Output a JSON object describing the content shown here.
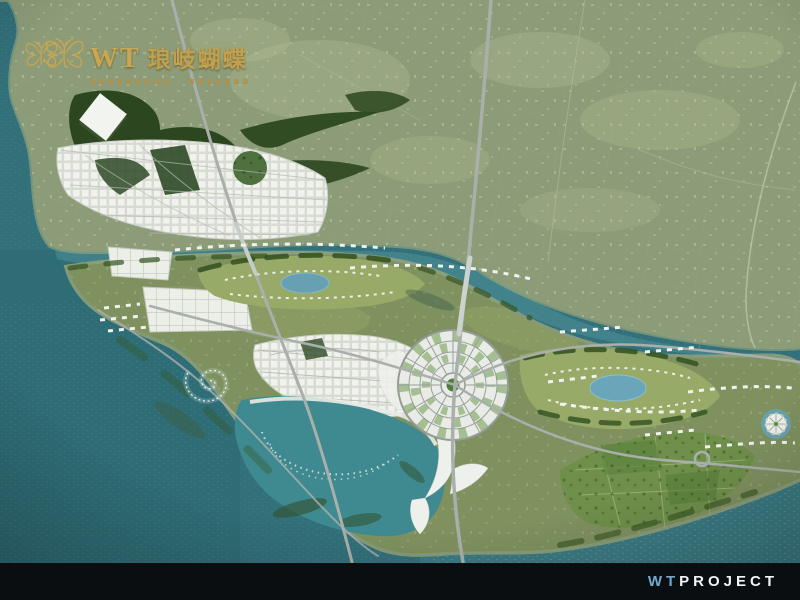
{
  "logo": {
    "brand": "WT",
    "name": "琅岐蝴蝶",
    "gold_color": "#c9a752",
    "icon": "butterfly-icon"
  },
  "footer": {
    "wt": "WT",
    "project": "PROJECT",
    "wt_color": "#73a9cf",
    "project_color": "#f2f4f6",
    "bar_color": "#0b0e11"
  },
  "scene": {
    "kind": "aerial-masterplan-rendering",
    "colors": {
      "sea": "#32707a",
      "channel": "#4f949b",
      "mainland": "#8c9c79",
      "island": "#7f915f",
      "sand": "#a2a878",
      "road": "#a9b0ac",
      "forest": "#2c471f",
      "lake": "#67a0b2",
      "white_fabric": "#edefe9"
    },
    "features": [
      "mainland-farmland",
      "tidal-channel",
      "langqi-island",
      "central-radial-hub",
      "left-fan-city",
      "west-grid-district",
      "dense-city-fabric",
      "eye-park-west-lake",
      "eye-park-east-lake",
      "lagoon-bay",
      "arc-piers",
      "spiral-pier",
      "white-diamond-landmark",
      "flower-pier",
      "villa-rows",
      "southeast-farm-plots",
      "forest-parkland",
      "north-south-expressway",
      "west-expressway",
      "east-ring-roads",
      "roundabout",
      "iconic-white-building"
    ]
  }
}
